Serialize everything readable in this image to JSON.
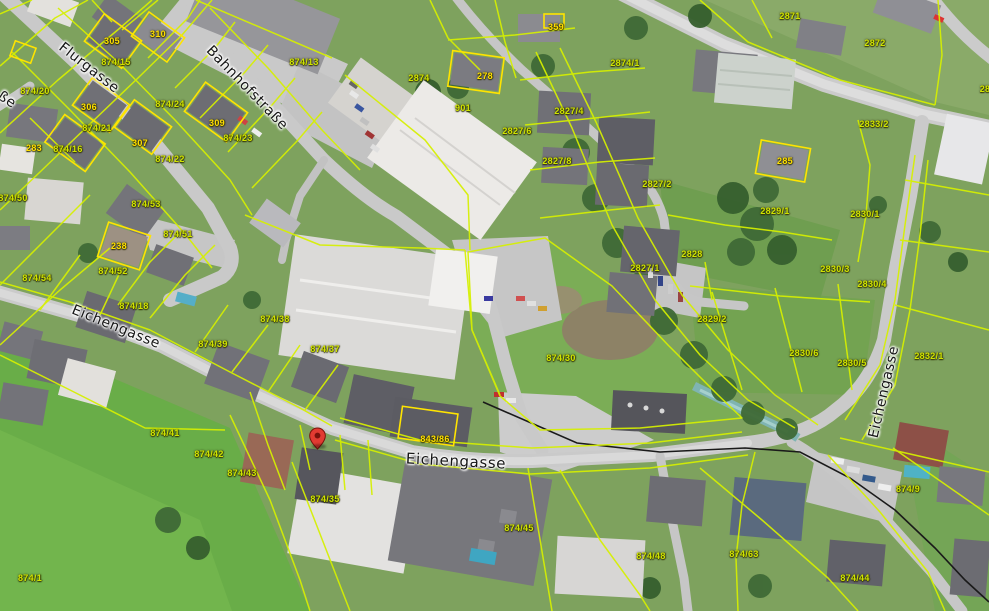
{
  "map": {
    "colors": {
      "parcel_line": "#d6f000",
      "building_outline": "#ffe400",
      "parcel_text": "#cfe300",
      "building_text": "#ffdf00",
      "marker": "#e23b32",
      "road": "#c8c8c8",
      "water": "#7fb4b2"
    },
    "street_labels": [
      {
        "name": "Flurgasse",
        "x": 89,
        "y": 68,
        "rot": 38,
        "size": 14
      },
      {
        "name": "Bahnhofstraße",
        "x": 247,
        "y": 88,
        "rot": 46,
        "size": 14
      },
      {
        "name": "ße",
        "x": 7,
        "y": 100,
        "rot": 33,
        "size": 14
      },
      {
        "name": "Eichengasse",
        "x": 116,
        "y": 327,
        "rot": 22,
        "size": 14
      },
      {
        "name": "Eichengasse",
        "x": 456,
        "y": 461,
        "rot": 3,
        "size": 15
      },
      {
        "name": "Eichengasse",
        "x": 884,
        "y": 392,
        "rot": -77,
        "size": 14
      }
    ],
    "parcel_labels": [
      {
        "label": "874/20",
        "x": 35,
        "y": 91
      },
      {
        "label": "874/15",
        "x": 116,
        "y": 62
      },
      {
        "label": "874/13",
        "x": 304,
        "y": 62
      },
      {
        "label": "874/24",
        "x": 170,
        "y": 104
      },
      {
        "label": "874/21",
        "x": 97,
        "y": 128
      },
      {
        "label": "874/16",
        "x": 68,
        "y": 149
      },
      {
        "label": "874/22",
        "x": 170,
        "y": 159
      },
      {
        "label": "874/23",
        "x": 238,
        "y": 138
      },
      {
        "label": "874/50",
        "x": 13,
        "y": 198
      },
      {
        "label": "874/53",
        "x": 146,
        "y": 204
      },
      {
        "label": "874/51",
        "x": 178,
        "y": 234
      },
      {
        "label": "874/52",
        "x": 113,
        "y": 271
      },
      {
        "label": "874/54",
        "x": 37,
        "y": 278
      },
      {
        "label": "874/18",
        "x": 134,
        "y": 306
      },
      {
        "label": "874/39",
        "x": 213,
        "y": 344
      },
      {
        "label": "874/38",
        "x": 275,
        "y": 319
      },
      {
        "label": "874/37",
        "x": 325,
        "y": 349
      },
      {
        "label": "874/30",
        "x": 561,
        "y": 358
      },
      {
        "label": "874/41",
        "x": 165,
        "y": 433
      },
      {
        "label": "874/42",
        "x": 209,
        "y": 454
      },
      {
        "label": "874/43",
        "x": 242,
        "y": 473
      },
      {
        "label": "874/35",
        "x": 325,
        "y": 499
      },
      {
        "label": "874/45",
        "x": 519,
        "y": 528
      },
      {
        "label": "874/48",
        "x": 651,
        "y": 556
      },
      {
        "label": "874/63",
        "x": 744,
        "y": 554
      },
      {
        "label": "874/44",
        "x": 855,
        "y": 578
      },
      {
        "label": "874/9",
        "x": 908,
        "y": 489
      },
      {
        "label": "874/1",
        "x": 30,
        "y": 578
      },
      {
        "label": "901",
        "x": 463,
        "y": 108
      },
      {
        "label": "2874",
        "x": 419,
        "y": 78
      },
      {
        "label": "2827/6",
        "x": 517,
        "y": 131
      },
      {
        "label": "2827/4",
        "x": 569,
        "y": 111
      },
      {
        "label": "2827/8",
        "x": 557,
        "y": 161
      },
      {
        "label": "2827/2",
        "x": 657,
        "y": 184
      },
      {
        "label": "2827/1",
        "x": 645,
        "y": 268
      },
      {
        "label": "2828",
        "x": 692,
        "y": 254
      },
      {
        "label": "2829/1",
        "x": 775,
        "y": 211
      },
      {
        "label": "2829/2",
        "x": 712,
        "y": 319
      },
      {
        "label": "2830/6",
        "x": 804,
        "y": 353
      },
      {
        "label": "2830/5",
        "x": 852,
        "y": 363
      },
      {
        "label": "2832/1",
        "x": 929,
        "y": 356
      },
      {
        "label": "2830/3",
        "x": 835,
        "y": 269
      },
      {
        "label": "2830/4",
        "x": 872,
        "y": 284
      },
      {
        "label": "2830/1",
        "x": 865,
        "y": 214
      },
      {
        "label": "2833/2",
        "x": 874,
        "y": 124
      },
      {
        "label": "2874/1",
        "x": 625,
        "y": 63
      },
      {
        "label": "2871",
        "x": 790,
        "y": 16
      },
      {
        "label": "2872",
        "x": 875,
        "y": 43
      },
      {
        "label": "28",
        "x": 985,
        "y": 89
      }
    ],
    "building_labels": [
      {
        "label": "310",
        "x": 158,
        "y": 34
      },
      {
        "label": "305",
        "x": 112,
        "y": 41
      },
      {
        "label": "306",
        "x": 89,
        "y": 107
      },
      {
        "label": "283",
        "x": 34,
        "y": 148
      },
      {
        "label": "307",
        "x": 140,
        "y": 143
      },
      {
        "label": "309",
        "x": 217,
        "y": 123
      },
      {
        "label": "278",
        "x": 485,
        "y": 76
      },
      {
        "label": "359",
        "x": 556,
        "y": 27
      },
      {
        "label": "238",
        "x": 119,
        "y": 246
      },
      {
        "label": "285",
        "x": 785,
        "y": 161
      },
      {
        "label": "843/86",
        "x": 435,
        "y": 439
      }
    ],
    "marker": {
      "x": 317,
      "y": 449
    }
  }
}
